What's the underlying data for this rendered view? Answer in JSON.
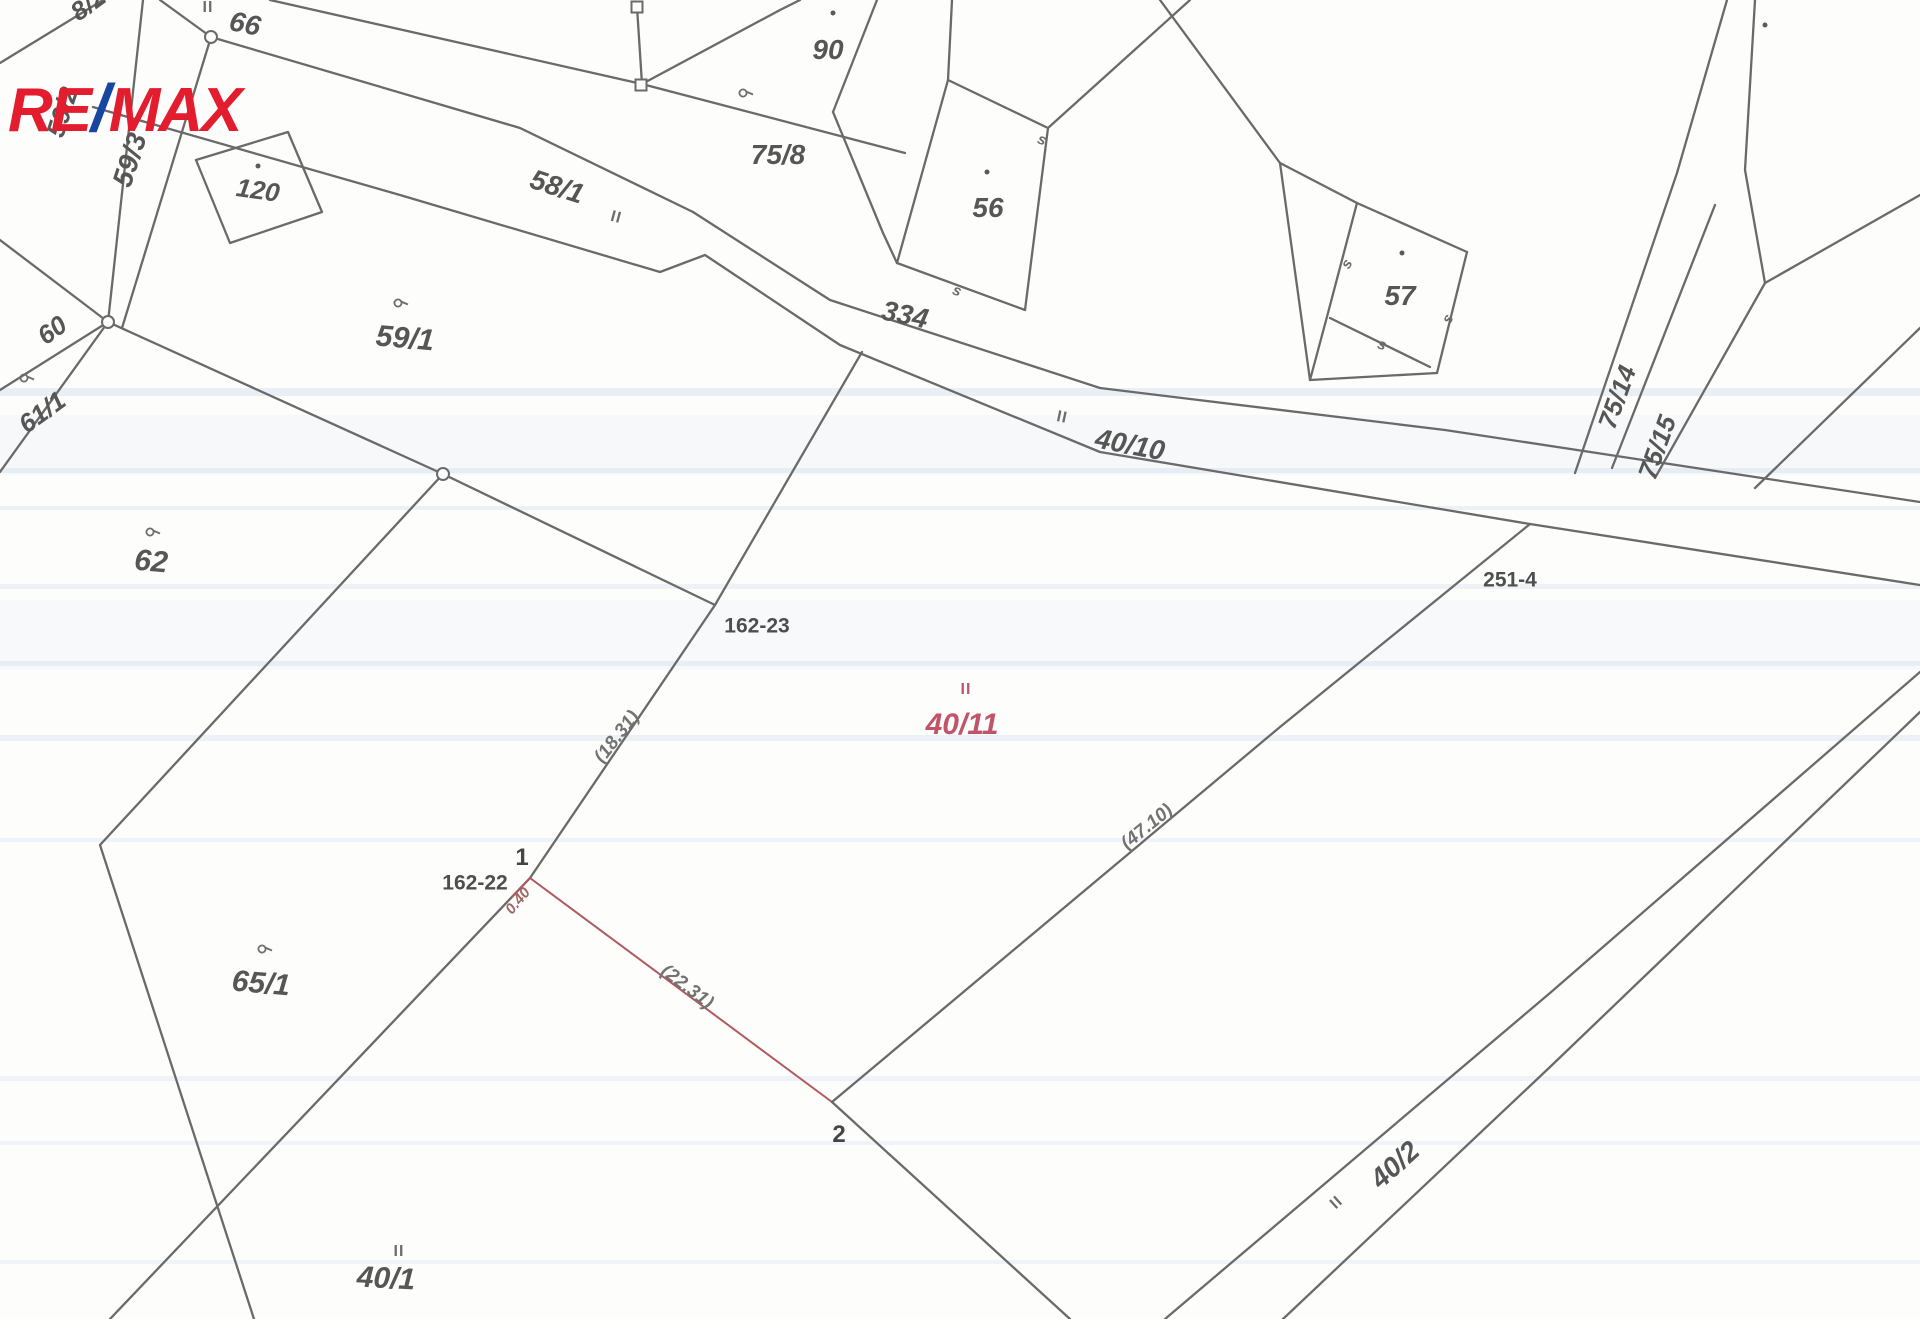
{
  "page": {
    "width": 1920,
    "height": 1319,
    "background": "#fdfdfc"
  },
  "logo": {
    "part1": "RE",
    "slash": "/",
    "part2": "MAX",
    "color_red": "#e31c2e",
    "color_blue": "#1746a0"
  },
  "map": {
    "line_color": "#6a6a6a",
    "red_line_color": "#b05a5f",
    "label_color": "#565656",
    "red_label_color": "#c0556a",
    "measure_color": "#737373",
    "point_color": "#454545",
    "stripe_color": "#ccd9ec",
    "labels": [
      {
        "text": "8/2",
        "x": 88,
        "y": 4,
        "rot": -36,
        "size": 26,
        "kind": "parcel"
      },
      {
        "text": "66",
        "x": 245,
        "y": 24,
        "rot": 12,
        "size": 28,
        "kind": "parcel"
      },
      {
        "text": "59/2",
        "x": 62,
        "y": 112,
        "rot": -72,
        "size": 26,
        "kind": "parcel"
      },
      {
        "text": "59/3",
        "x": 130,
        "y": 160,
        "rot": -72,
        "size": 28,
        "kind": "parcel"
      },
      {
        "text": "120",
        "x": 258,
        "y": 190,
        "rot": 8,
        "size": 26,
        "kind": "parcel"
      },
      {
        "text": "58/1",
        "x": 557,
        "y": 187,
        "rot": 18,
        "size": 28,
        "kind": "parcel"
      },
      {
        "text": "90",
        "x": 828,
        "y": 50,
        "rot": 0,
        "size": 28,
        "kind": "parcel"
      },
      {
        "text": "75/8",
        "x": 778,
        "y": 155,
        "rot": 0,
        "size": 28,
        "kind": "parcel"
      },
      {
        "text": "56",
        "x": 988,
        "y": 208,
        "rot": 0,
        "size": 28,
        "kind": "parcel"
      },
      {
        "text": "57",
        "x": 1400,
        "y": 296,
        "rot": 0,
        "size": 28,
        "kind": "parcel"
      },
      {
        "text": "334",
        "x": 905,
        "y": 315,
        "rot": 12,
        "size": 28,
        "kind": "parcel"
      },
      {
        "text": "40/10",
        "x": 1130,
        "y": 445,
        "rot": 11,
        "size": 28,
        "kind": "parcel"
      },
      {
        "text": "60",
        "x": 52,
        "y": 330,
        "rot": -36,
        "size": 26,
        "kind": "parcel"
      },
      {
        "text": "61/1",
        "x": 42,
        "y": 412,
        "rot": -36,
        "size": 26,
        "kind": "parcel"
      },
      {
        "text": "59/1",
        "x": 405,
        "y": 339,
        "rot": 5,
        "size": 30,
        "kind": "parcel"
      },
      {
        "text": "75/14",
        "x": 1617,
        "y": 397,
        "rot": -70,
        "size": 26,
        "kind": "parcel"
      },
      {
        "text": "75/15",
        "x": 1657,
        "y": 447,
        "rot": -70,
        "size": 26,
        "kind": "parcel"
      },
      {
        "text": "62",
        "x": 151,
        "y": 562,
        "rot": 5,
        "size": 30,
        "kind": "parcel"
      },
      {
        "text": "251-4",
        "x": 1510,
        "y": 580,
        "rot": 0,
        "size": 21,
        "kind": "survey"
      },
      {
        "text": "162-23",
        "x": 757,
        "y": 626,
        "rot": 0,
        "size": 21,
        "kind": "survey"
      },
      {
        "text": "40/11",
        "x": 962,
        "y": 725,
        "rot": 0,
        "size": 30,
        "kind": "red-parcel"
      },
      {
        "text": "(18.31)",
        "x": 617,
        "y": 737,
        "rot": -52,
        "size": 19,
        "kind": "measure"
      },
      {
        "text": "(47.10)",
        "x": 1147,
        "y": 827,
        "rot": -39,
        "size": 19,
        "kind": "measure"
      },
      {
        "text": "162-22",
        "x": 475,
        "y": 883,
        "rot": 0,
        "size": 21,
        "kind": "survey"
      },
      {
        "text": "1",
        "x": 522,
        "y": 858,
        "rot": 0,
        "size": 24,
        "kind": "point"
      },
      {
        "text": "0.40",
        "x": 518,
        "y": 901,
        "rot": -50,
        "size": 15,
        "kind": "red-measure"
      },
      {
        "text": "(22.31)",
        "x": 687,
        "y": 987,
        "rot": 37,
        "size": 19,
        "kind": "measure"
      },
      {
        "text": "2",
        "x": 839,
        "y": 1135,
        "rot": 0,
        "size": 24,
        "kind": "point"
      },
      {
        "text": "65/1",
        "x": 261,
        "y": 984,
        "rot": 5,
        "size": 30,
        "kind": "parcel"
      },
      {
        "text": "40/1",
        "x": 386,
        "y": 1279,
        "rot": 3,
        "size": 30,
        "kind": "parcel"
      },
      {
        "text": "40/2",
        "x": 1395,
        "y": 1165,
        "rot": -42,
        "size": 28,
        "kind": "parcel"
      }
    ],
    "lines": [
      {
        "pts": [
          [
            160,
            0
          ],
          [
            211,
            37
          ],
          [
            520,
            128
          ],
          [
            693,
            212
          ]
        ]
      },
      {
        "pts": [
          [
            143,
            0
          ],
          [
            108,
            322
          ]
        ]
      },
      {
        "pts": [
          [
            211,
            37
          ],
          [
            122,
            328
          ]
        ]
      },
      {
        "pts": [
          [
            0,
            63
          ],
          [
            103,
            0
          ]
        ]
      },
      {
        "pts": [
          [
            0,
            240
          ],
          [
            108,
            322
          ]
        ]
      },
      {
        "pts": [
          [
            108,
            322
          ],
          [
            0,
            390
          ]
        ]
      },
      {
        "pts": [
          [
            108,
            322
          ],
          [
            0,
            472
          ]
        ]
      },
      {
        "pts": [
          [
            108,
            322
          ],
          [
            443,
            474
          ]
        ]
      },
      {
        "pts": [
          [
            443,
            474
          ],
          [
            715,
            605
          ]
        ]
      },
      {
        "pts": [
          [
            443,
            474
          ],
          [
            100,
            845
          ],
          [
            254,
            1319
          ]
        ]
      },
      {
        "pts": [
          [
            715,
            605
          ],
          [
            530,
            878
          ],
          [
            110,
            1319
          ]
        ]
      },
      {
        "pts": [
          [
            715,
            605
          ],
          [
            862,
            352
          ]
        ]
      },
      {
        "pts": [
          [
            530,
            878
          ],
          [
            832,
            1102
          ]
        ],
        "c": "red",
        "w": 2
      },
      {
        "pts": [
          [
            530,
            878
          ],
          [
            512,
            897
          ]
        ],
        "c": "red",
        "w": 2
      },
      {
        "pts": [
          [
            832,
            1102
          ],
          [
            1070,
            1319
          ]
        ]
      },
      {
        "pts": [
          [
            1530,
            524
          ],
          [
            1280,
            727
          ],
          [
            832,
            1102
          ]
        ]
      },
      {
        "pts": [
          [
            93,
            107
          ],
          [
            400,
            195
          ],
          [
            660,
            272
          ],
          [
            705,
            255
          ],
          [
            840,
            345
          ],
          [
            1100,
            452
          ],
          [
            1530,
            524
          ],
          [
            1920,
            585
          ]
        ]
      },
      {
        "pts": [
          [
            693,
            212
          ],
          [
            830,
            300
          ],
          [
            1100,
            388
          ],
          [
            1445,
            430
          ],
          [
            1920,
            502
          ]
        ]
      },
      {
        "pts": [
          [
            270,
            0
          ],
          [
            642,
            84
          ],
          [
            905,
            153
          ]
        ]
      },
      {
        "pts": [
          [
            637,
            7
          ],
          [
            642,
            84
          ]
        ]
      },
      {
        "pts": [
          [
            642,
            84
          ],
          [
            780,
            10
          ],
          [
            800,
            0
          ]
        ]
      },
      {
        "pts": [
          [
            877,
            0
          ],
          [
            833,
            112
          ]
        ]
      },
      {
        "pts": [
          [
            833,
            112
          ],
          [
            883,
            233
          ],
          [
            897,
            263
          ]
        ]
      },
      {
        "pts": [
          [
            952,
            0
          ],
          [
            948,
            80
          ]
        ]
      },
      {
        "pts": [
          [
            948,
            80
          ],
          [
            1048,
            128
          ]
        ]
      },
      {
        "pts": [
          [
            1048,
            128
          ],
          [
            1025,
            310
          ]
        ]
      },
      {
        "pts": [
          [
            1025,
            310
          ],
          [
            897,
            263
          ]
        ]
      },
      {
        "pts": [
          [
            897,
            263
          ],
          [
            948,
            80
          ]
        ]
      },
      {
        "pts": [
          [
            1048,
            128
          ],
          [
            1190,
            0
          ]
        ]
      },
      {
        "pts": [
          [
            1160,
            0
          ],
          [
            1280,
            163
          ]
        ]
      },
      {
        "pts": [
          [
            1280,
            163
          ],
          [
            1357,
            203
          ]
        ]
      },
      {
        "pts": [
          [
            1280,
            163
          ],
          [
            1310,
            380
          ]
        ]
      },
      {
        "pts": [
          [
            1357,
            203
          ],
          [
            1467,
            252
          ]
        ]
      },
      {
        "pts": [
          [
            1467,
            252
          ],
          [
            1437,
            373
          ]
        ]
      },
      {
        "pts": [
          [
            1437,
            373
          ],
          [
            1310,
            380
          ]
        ]
      },
      {
        "pts": [
          [
            1357,
            203
          ],
          [
            1328,
            313
          ],
          [
            1310,
            380
          ]
        ]
      },
      {
        "pts": [
          [
            1330,
            318
          ],
          [
            1430,
            367
          ]
        ]
      },
      {
        "pts": [
          [
            1727,
            0
          ],
          [
            1677,
            173
          ],
          [
            1575,
            473
          ]
        ]
      },
      {
        "pts": [
          [
            1755,
            0
          ],
          [
            1745,
            170
          ],
          [
            1765,
            283
          ],
          [
            1655,
            478
          ]
        ]
      },
      {
        "pts": [
          [
            1920,
            195
          ],
          [
            1765,
            283
          ]
        ]
      },
      {
        "pts": [
          [
            1715,
            205
          ],
          [
            1612,
            468
          ]
        ]
      },
      {
        "pts": [
          [
            1920,
            328
          ],
          [
            1755,
            488
          ]
        ]
      },
      {
        "pts": [
          [
            1920,
            672
          ],
          [
            1550,
            993
          ],
          [
            1165,
            1319
          ]
        ]
      },
      {
        "pts": [
          [
            1920,
            712
          ],
          [
            1550,
            1067
          ],
          [
            1283,
            1319
          ]
        ]
      },
      {
        "pts": [
          [
            196,
            160
          ],
          [
            288,
            132
          ],
          [
            322,
            212
          ],
          [
            230,
            243
          ],
          [
            196,
            160
          ]
        ]
      }
    ],
    "symbols": [
      {
        "type": "dot",
        "x": 258,
        "y": 166
      },
      {
        "type": "dot",
        "x": 833,
        "y": 13
      },
      {
        "type": "dot",
        "x": 987,
        "y": 172
      },
      {
        "type": "dot",
        "x": 1402,
        "y": 253
      },
      {
        "type": "dot",
        "x": 1765,
        "y": 25
      },
      {
        "type": "circle-vertex",
        "x": 211,
        "y": 37
      },
      {
        "type": "circle-vertex",
        "x": 108,
        "y": 322
      },
      {
        "type": "circle-vertex",
        "x": 443,
        "y": 474
      },
      {
        "type": "square-vertex",
        "x": 637,
        "y": 7
      },
      {
        "type": "square-vertex",
        "x": 641,
        "y": 85
      },
      {
        "type": "s-mark",
        "x": 1042,
        "y": 140,
        "rot": 20
      },
      {
        "type": "s-mark",
        "x": 957,
        "y": 291,
        "rot": 20
      },
      {
        "type": "s-mark",
        "x": 1347,
        "y": 264,
        "rot": -60
      },
      {
        "type": "s-mark",
        "x": 1448,
        "y": 319,
        "rot": -60
      },
      {
        "type": "s-mark",
        "x": 1382,
        "y": 345,
        "rot": 20
      },
      {
        "type": "use-mark",
        "x": 208,
        "y": 8,
        "rot": 0
      },
      {
        "type": "use-mark",
        "x": 616,
        "y": 218,
        "rot": 15
      },
      {
        "type": "use-mark",
        "x": 1062,
        "y": 418,
        "rot": 12
      },
      {
        "type": "use-mark",
        "x": 966,
        "y": 690,
        "rot": 0,
        "red": true
      },
      {
        "type": "use-mark",
        "x": 399,
        "y": 1252,
        "rot": 0
      },
      {
        "type": "use-mark",
        "x": 1337,
        "y": 1203,
        "rot": -42
      },
      {
        "type": "landuse",
        "x": 402,
        "y": 305
      },
      {
        "type": "landuse",
        "x": 747,
        "y": 95
      },
      {
        "type": "landuse",
        "x": 28,
        "y": 380
      },
      {
        "type": "landuse",
        "x": 154,
        "y": 534
      },
      {
        "type": "landuse",
        "x": 266,
        "y": 951
      }
    ],
    "scan_stripes": [
      {
        "y": 388,
        "h": 8,
        "op": 0.4
      },
      {
        "y": 415,
        "h": 60,
        "op": 0.14
      },
      {
        "y": 468,
        "h": 5,
        "op": 0.35
      },
      {
        "y": 506,
        "h": 4,
        "op": 0.35
      },
      {
        "y": 584,
        "h": 5,
        "op": 0.3
      },
      {
        "y": 600,
        "h": 70,
        "op": 0.1
      },
      {
        "y": 661,
        "h": 5,
        "op": 0.35
      },
      {
        "y": 735,
        "h": 6,
        "op": 0.35
      },
      {
        "y": 838,
        "h": 4,
        "op": 0.28
      },
      {
        "y": 1076,
        "h": 5,
        "op": 0.28
      },
      {
        "y": 1141,
        "h": 4,
        "op": 0.25
      },
      {
        "y": 1260,
        "h": 4,
        "op": 0.25
      }
    ]
  }
}
